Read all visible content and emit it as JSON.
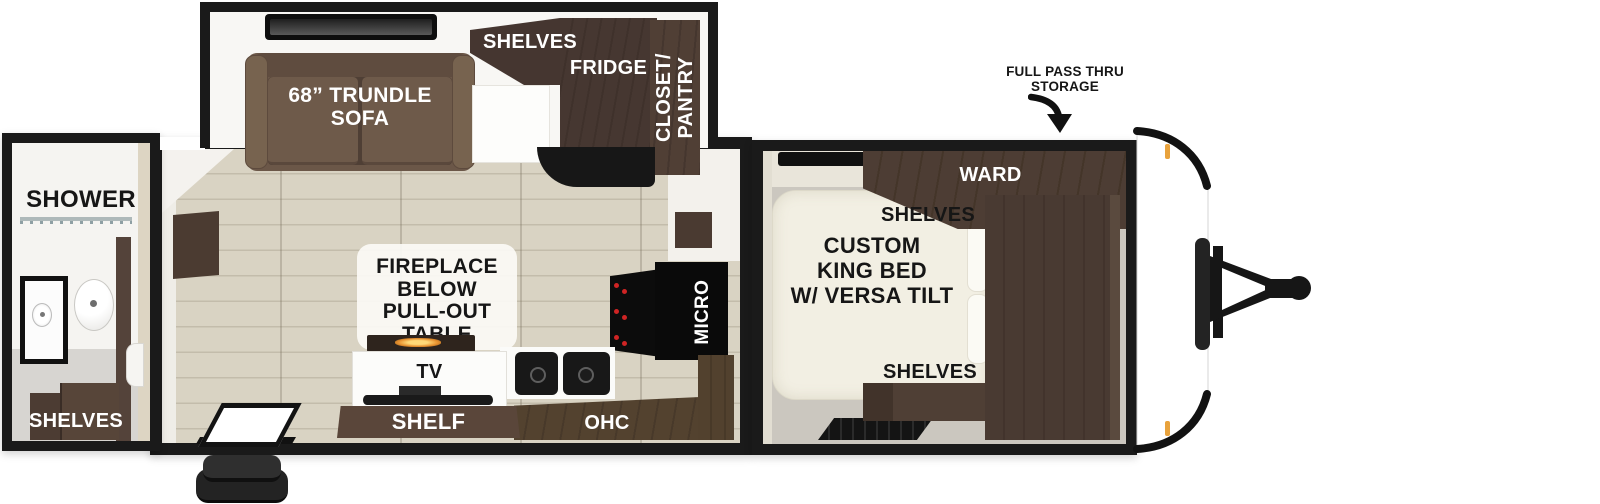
{
  "title": "Travel trailer floorplan",
  "colors": {
    "outline": "#1a1a1a",
    "cabinet": "#4a3a31",
    "cabinet_dark": "#3f312b",
    "sofa": "#6b5748",
    "floor_wood": "#d9d3c3",
    "plank_line": "#c3bcab",
    "bed": "#f2efe3",
    "floor_gray": "#cbc7bf",
    "marker": "#e8a23c",
    "flame": "#e89230"
  },
  "rear_bath": {
    "shower_label": "SHOWER",
    "shelves_label": "SHELVES"
  },
  "slide_out": {
    "sofa_label": "68” TRUNDLE\nSOFA",
    "shelves_label": "SHELVES",
    "fridge_label": "FRIDGE",
    "closet_label": "CLOSET/\nPANTRY"
  },
  "living": {
    "fireplace_label": "FIREPLACE\nBELOW\nPULL-OUT TABLE",
    "tv_label": "TV",
    "shelf_label": "SHELF",
    "ohc_label": "OHC",
    "micro_label": "MICRO"
  },
  "bedroom": {
    "bed_label": "CUSTOM\nKING BED\nW/ VERSA TILT",
    "ward_label": "WARD",
    "shelves_top_label": "SHELVES",
    "shelves_bottom_label": "SHELVES"
  },
  "front": {
    "storage_label": "FULL PASS THRU\nSTORAGE"
  }
}
